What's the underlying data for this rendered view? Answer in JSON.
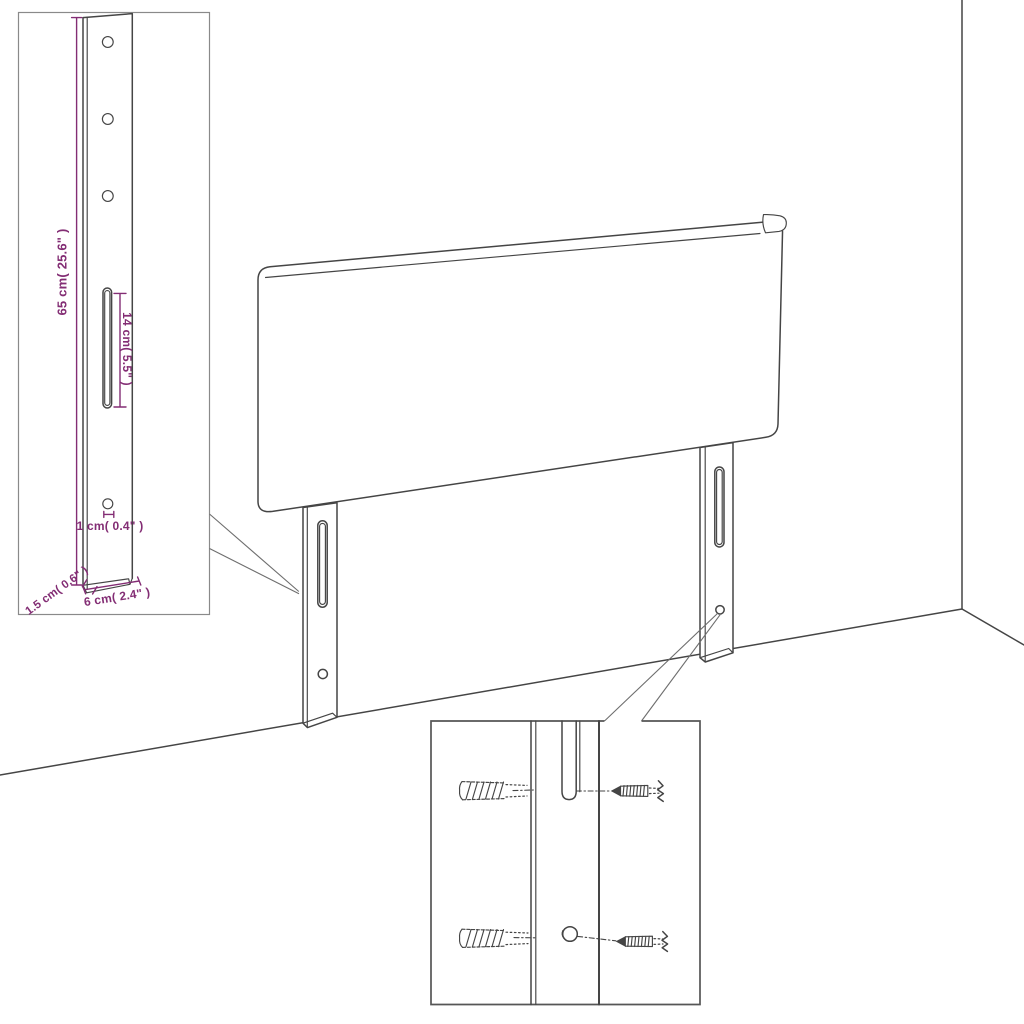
{
  "diagram": {
    "kind": "headboard wall-mount dimension diagram",
    "dimensions": {
      "bracket_height": "65 cm( 25.6\" )",
      "slot_length": "14 cm( 5.5\" )",
      "hole_diameter": "1 cm( 0.4\" )",
      "bracket_thickness": "1.5 cm( 0.6\" )",
      "bracket_width": "6 cm( 2.4\" )"
    },
    "icons": {
      "wall_plug": "wall-plug-icon",
      "screw": "screw-icon"
    },
    "colors": {
      "background": "#ffffff",
      "line": "#454545",
      "dimension": "#832d74",
      "inset_border": "#8a8a8a"
    }
  }
}
